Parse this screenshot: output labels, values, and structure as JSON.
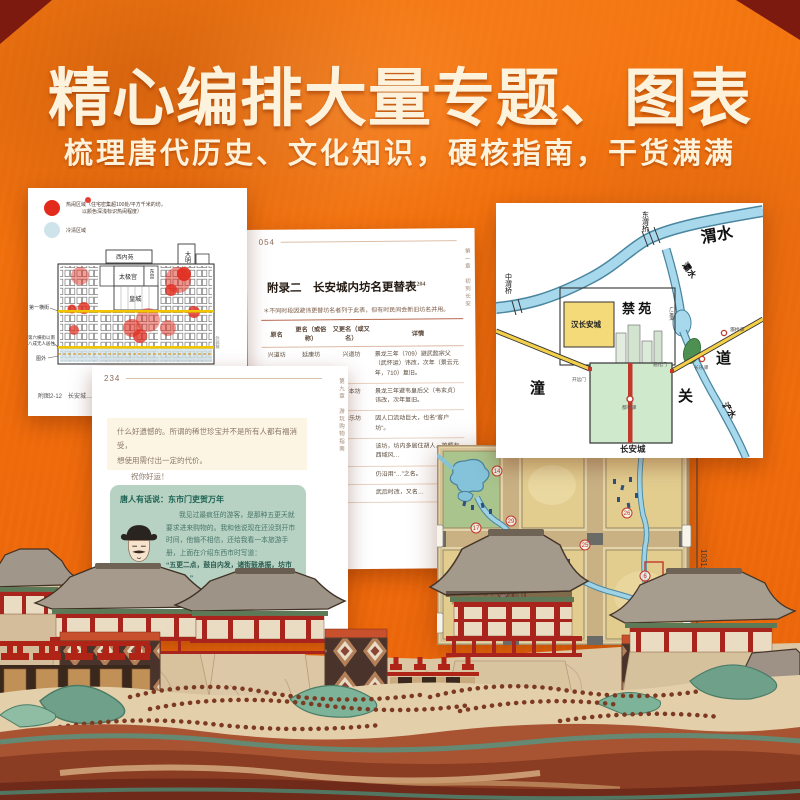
{
  "header": {
    "title": "精心编排大量专题、图表",
    "subtitle": "梳理唐代历史、文化知识，硬核指南，干货满满"
  },
  "colors": {
    "background_orange": "#ee6a0b",
    "corner_red": "#7d1a10",
    "heat_red": "#e22b1d",
    "cold_blue": "#cfe4ea",
    "dialog_green": "#b7d2c3",
    "river_blue": "#a8d8ec",
    "road_yellow": "#f4d04a"
  },
  "density_card": {
    "legend_hot_1": "热闹区域（住宅密集超100处/平方千米的坊，",
    "legend_hot_2": "以颜色深浅标识热闹程度）",
    "legend_cold": "冷清区域",
    "palaces": {
      "daming": "大明宫",
      "xinei": "西内苑",
      "yeting": "掖庭宫",
      "taiji": "太极宫",
      "dong": "东宫",
      "huang": "皇城"
    },
    "side_first_street": "第一横街",
    "side_south_1": "第六横街以南",
    "side_south_2": "八成无人居住",
    "side_outside": "图外",
    "side_right": "外郭城",
    "caption": "附图2-12　长安城…"
  },
  "table_card": {
    "page_number": "054",
    "chapter_vertical": "第一章　初到长安",
    "title": "附录二　长安城内坊名更替表",
    "superscript": "204",
    "note": "＊不同时段因避讳更替坊名者列于此表，但有时民间会新旧坊名并用。",
    "headers": [
      "原名",
      "更名（或俗称）",
      "又更名（或又名）",
      "详情"
    ],
    "rows": [
      [
        "兴道坊",
        "延康坊",
        "兴道坊",
        "景龙三年（709）避武懿宗父（武怀运）讳改，次年（景云元年，710）复旧。"
      ],
      [
        "务本坊",
        "玉楼坊",
        "务本坊",
        "景龙三年避韦皇后父（韦玄贞）讳改，次年复旧。"
      ],
      [
        "怀德坊",
        "",
        "永乐坊",
        "因人口流动巨大，也名“客户坊”。"
      ],
      [
        "道政坊",
        "",
        "",
        "该坊，坊内多居住胡人，故颇有西域风…"
      ],
      [
        "",
        "",
        "",
        "仍沿用“…”之名。"
      ],
      [
        "",
        "",
        "",
        "武后时改，又名…"
      ]
    ]
  },
  "guide_card": {
    "page_number": "234",
    "chapter_vertical": "第九章　游玩购物指南",
    "intro_1": "什么好遗憾的。所谓的稀世珍宝并不是所有人都有福消受，",
    "intro_2": "想使用需付出一定的代价。",
    "wish": "祝你好运！",
    "dialog_title": "唐人有话说：东市门吏贺万年",
    "dialog_p1": "我见过最疯狂的游客，是那种五更天就要求进来购物的。我和他说现在还没到开市时间，他偏不相信，还给我看一本旅游手册，上面在介绍东西市时写道：",
    "dialog_quote": "“五更二点，鼓自内发，诸街鼓承振，坊市门皆启。”",
    "dialog_p2": "他拿着手册和我理论，说既然五更二点坊市门皆启，为什么还不让他进来……他不听，希望衙门帮他安排守市的工作。",
    "special_title": "特别提醒",
    "special_fragment": "东西二市的市门也…"
  },
  "region_map": {
    "weishui": "渭水",
    "dongweiqiao": "东渭桥",
    "zhongweiqiao": "中渭桥",
    "bashui": "灞水",
    "jinyuan": "禁  苑",
    "hanchangan": "汉长安城",
    "changan_box": "长安城",
    "tong": "潼",
    "guan": "关",
    "dao": "道",
    "chanshui": "浐水",
    "guangyuntan": "广运潭",
    "kaiyuanmen": "开远门",
    "tonghuamen": "通化门",
    "dutingyi": "都亭驿",
    "changleyi": "长乐驿",
    "baqiaoyi": "灞桥驿"
  },
  "painted_map": {
    "dimension": "1031米",
    "note_1": "东西向、南北向",
    "note_2": "街道均宽16米",
    "markers": [
      "14",
      "29",
      "17",
      "10",
      "9",
      "27",
      "25",
      "26",
      "6",
      "20",
      "8",
      "23"
    ]
  }
}
